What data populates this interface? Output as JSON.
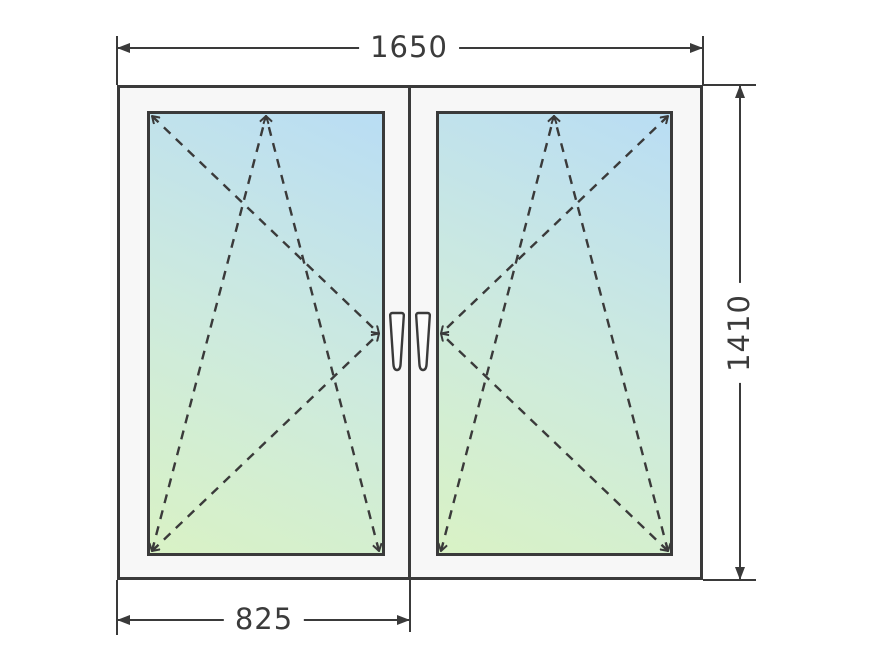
{
  "diagram": {
    "title": "two-sash-window-drawing",
    "dimensions": {
      "total_width": "1650",
      "total_height": "1410",
      "sash_width": "825"
    },
    "window": {
      "sash_count": 2,
      "sashes": [
        {
          "id": "left",
          "opening": "tilt-and-turn",
          "hinge_side": "left",
          "handle_position": "right-stile"
        },
        {
          "id": "right",
          "opening": "tilt-and-turn",
          "hinge_side": "right",
          "handle_position": "left-stile"
        }
      ]
    }
  },
  "colors": {
    "line": "#3a3a3a",
    "frame_fill": "#f7f7f7",
    "glass_top": "#b9ddf4",
    "glass_mid": "#cdeade",
    "glass_bottom": "#d9f2c5",
    "handle_fill": "#fcfcfc",
    "background": "#ffffff",
    "label_text": "#3b3b3b"
  }
}
